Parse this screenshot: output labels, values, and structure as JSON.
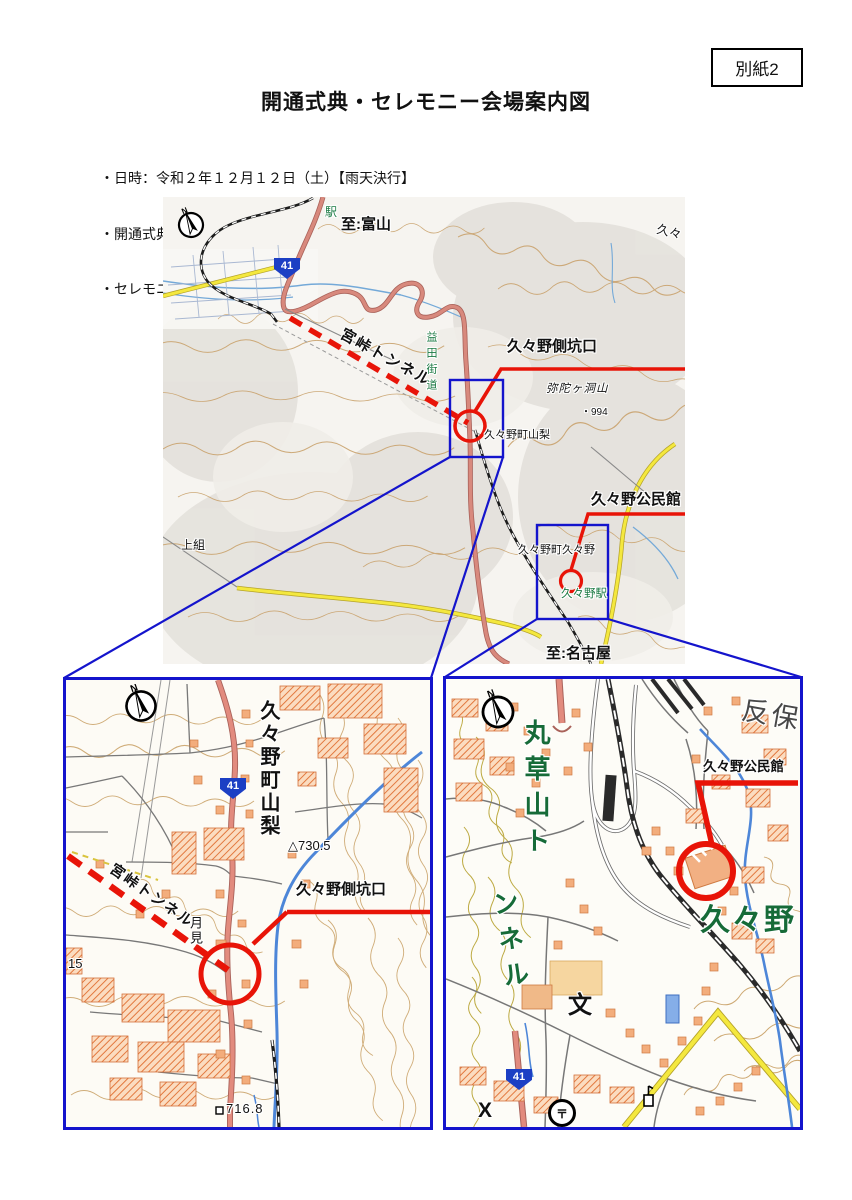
{
  "page": {
    "attachment_tag": "別紙2",
    "title": "開通式典・セレモニー会場案内図",
    "bullets": [
      "・日時：令和２年１２月１２日（土）【雨天決行】",
      "・開通式典　：１０時００分～　久々野町公民館（高山市久々野町久々野1505-4）",
      "・セレモニー：１１時２０分～　久々野町側坑口"
    ]
  },
  "main_map": {
    "labels": {
      "station": "駅",
      "to_toyama": "至:富山",
      "kuguno_edge": "久々",
      "route41": "41",
      "miya_tunnel": "宮峠トンネル",
      "masuda_kaido": "益田街道",
      "kuguno_portal": "久々野側坑口",
      "midagahora": "弥陀ヶ洞山",
      "spot_994": "・994",
      "yamanashi": "久々野町山梨",
      "kamigumi": "上組",
      "kuguno_town": "久々野町久々野",
      "kuguno_station": "久々野駅",
      "kuguno_hall": "久々野公民館",
      "to_nagoya": "至:名古屋"
    }
  },
  "left_map": {
    "labels": {
      "yamanashi_v": "久々野町山梨",
      "route41": "41",
      "spot_730": "△730.5",
      "miya_tunnel": "宮峠トンネル",
      "kuguno_portal": "久々野側坑口",
      "tsukimi": "月見",
      "grid_15": "15",
      "bench_716": "716.8"
    }
  },
  "right_map": {
    "labels": {
      "marukusa_col1": "丸草山ト",
      "marukusa_col2": "ンネル",
      "tanbo": "反保",
      "kuguno_hall": "久々野公民館",
      "kuguno_big": "久々野",
      "route41": "41",
      "school": "文",
      "post": "〒",
      "police": "X"
    }
  },
  "colors": {
    "annotation_red": "#e81408",
    "frame_blue": "#1414cc",
    "route_shield_blue": "#1c3fc4",
    "map_green": "#1b7a43",
    "road_pink": "#d8897d",
    "road_yellow": "#f4e83e",
    "water_blue": "#4d86d8",
    "contour_tan": "#c89f63",
    "building_orange": "#f3ad7c"
  }
}
